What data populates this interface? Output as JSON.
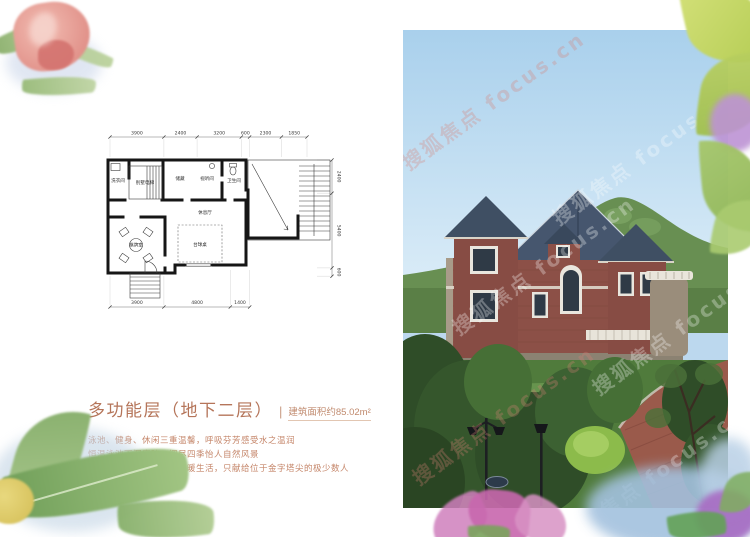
{
  "info": {
    "title": "多功能层（地下二层）",
    "separator": "|",
    "area": "建筑面积约85.02m²",
    "desc_lines": [
      "泳池、健身、休闲三重温馨，呼吸芬芳感受水之温润",
      "恒温泳池下沉庭院，阅尽四季怡人自然风景",
      "别墅私家电梯，太阳能采暖生活，只献给位于金字塔尖的极少数人"
    ]
  },
  "floorplan": {
    "dims_top": [
      "3900",
      "2400",
      "3200",
      "600",
      "2300",
      "1850"
    ],
    "dims_right": [
      "2400",
      "5400",
      "600"
    ],
    "dims_bottom": [
      "3900",
      "4800",
      "1400"
    ],
    "rooms": {
      "laundry": "洗衣间",
      "elevator": "别墅电梯",
      "storage": "储藏",
      "av": "视听间",
      "bath": "卫生间",
      "lounge": "休息厅",
      "billiards": "台球桌",
      "cards": "棋牌室"
    }
  },
  "photo": {
    "watermark": "搜狐焦点 focus.cn"
  },
  "colors": {
    "accent_text": "#b5755a",
    "desc_text": "#c5866a",
    "plan_line": "#161616",
    "sky": "#bcd8ee",
    "mountain": "#688f52",
    "brick": "#8c5047",
    "roof": "#46566e"
  }
}
